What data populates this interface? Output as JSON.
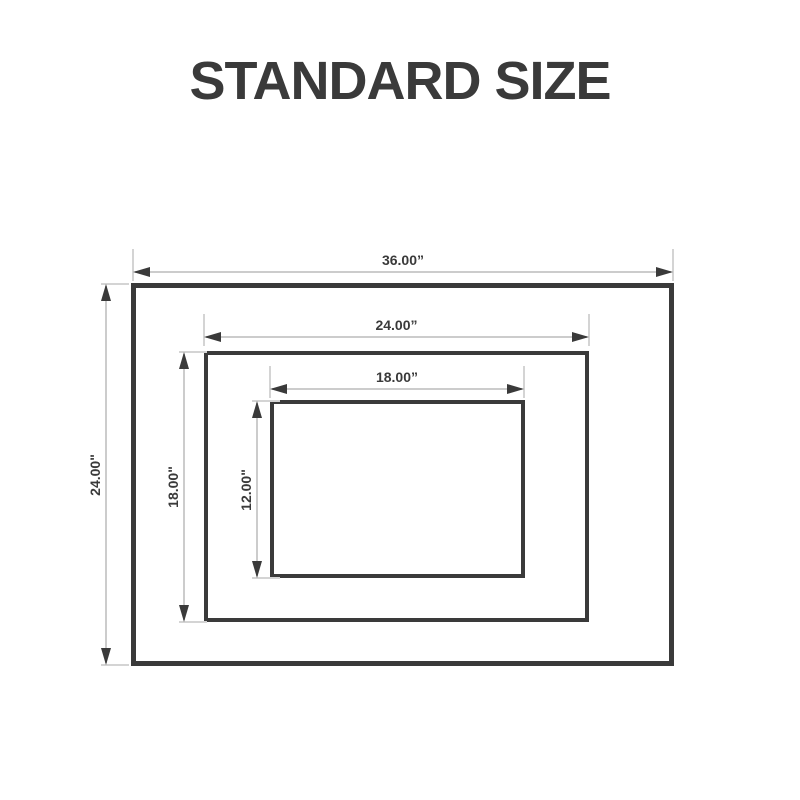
{
  "title": "STANDARD SIZE",
  "colors": {
    "background": "#ffffff",
    "ink": "#3a3a3a",
    "dimension_line": "#cccccc"
  },
  "dimensions": {
    "outer": {
      "width_label": "36.00”",
      "height_label": "24.00\""
    },
    "middle": {
      "width_label": "24.00”",
      "height_label": "18.00\""
    },
    "inner": {
      "width_label": "18.00”",
      "height_label": "12.00\""
    }
  }
}
